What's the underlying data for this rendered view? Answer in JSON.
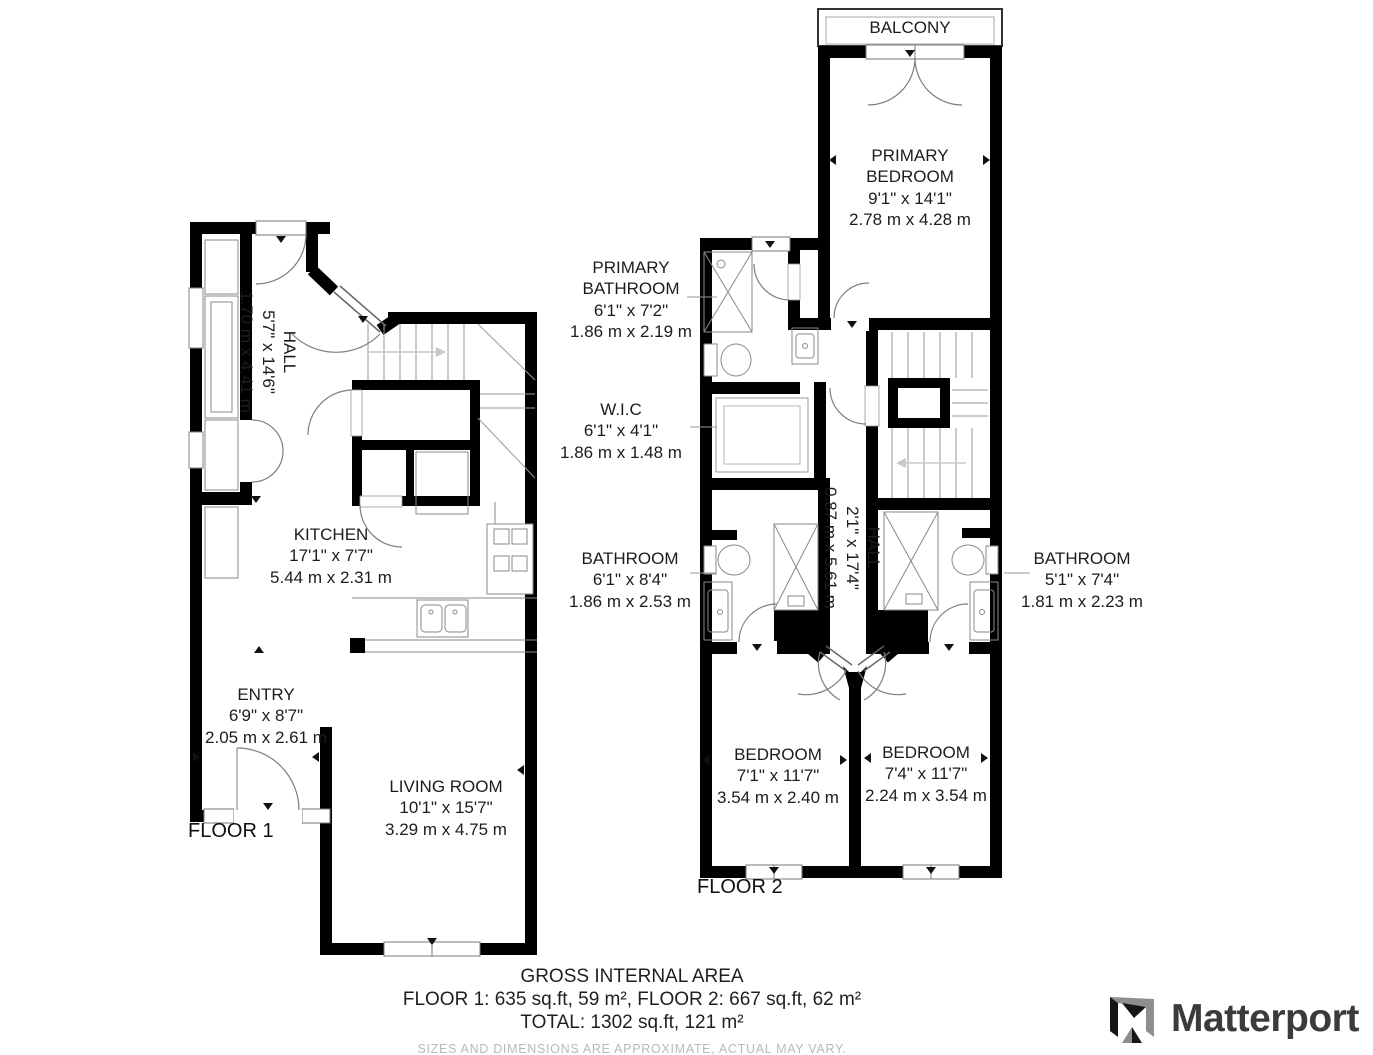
{
  "floor1": {
    "label": "FLOOR 1",
    "hall": {
      "name": "HALL",
      "imp": "5'7\" x 14'6\"",
      "met": "1.70 m x 4.41 m"
    },
    "kitchen": {
      "name": "KITCHEN",
      "imp": "17'1\" x 7'7\"",
      "met": "5.44 m x 2.31 m"
    },
    "entry": {
      "name": "ENTRY",
      "imp": "6'9\" x 8'7\"",
      "met": "2.05 m x 2.61 m"
    },
    "living": {
      "name": "LIVING ROOM",
      "imp": "10'1\" x 15'7\"",
      "met": "3.29 m x 4.75 m"
    }
  },
  "floor2": {
    "label": "FLOOR 2",
    "balcony": {
      "name": "BALCONY"
    },
    "primary_bedroom": {
      "name": "PRIMARY BEDROOM",
      "imp": "9'1\" x 14'1\"",
      "met": "2.78 m x 4.28 m"
    },
    "primary_bathroom": {
      "name": "PRIMARY BATHROOM",
      "imp": "6'1\" x 7'2\"",
      "met": "1.86 m x 2.19 m"
    },
    "wic": {
      "name": "W.I.C",
      "imp": "6'1\" x 4'1\"",
      "met": "1.86 m x 1.48 m"
    },
    "bathroom_left": {
      "name": "BATHROOM",
      "imp": "6'1\" x 8'4\"",
      "met": "1.86 m x 2.53 m"
    },
    "hall": {
      "name": "HALL",
      "imp": "2'1\" x 17'4\"",
      "met": "0.87 m x 5.61 m"
    },
    "bathroom_right": {
      "name": "BATHROOM",
      "imp": "5'1\" x 7'4\"",
      "met": "1.81 m x 2.23 m"
    },
    "bedroom_left": {
      "name": "BEDROOM",
      "imp": "7'1\" x 11'7\"",
      "met": "3.54 m x 2.40 m"
    },
    "bedroom_right": {
      "name": "BEDROOM",
      "imp": "7'4\" x 11'7\"",
      "met": "2.24 m x 3.54 m"
    }
  },
  "summary": {
    "title": "GROSS INTERNAL AREA",
    "floors": "FLOOR 1: 635 sq.ft, 59 m², FLOOR 2: 667 sq.ft, 62 m²",
    "total": "TOTAL: 1302 sq.ft, 121 m²",
    "disclaimer": "SIZES AND DIMENSIONS ARE APPROXIMATE, ACTUAL MAY VARY."
  },
  "branding": {
    "name": "Matterport"
  },
  "colors": {
    "wall": "#000000",
    "thin_line": "#888888",
    "leader": "#999999",
    "disclaimer_text": "#b9b9b9",
    "logo_text": "#3b3b3b"
  }
}
